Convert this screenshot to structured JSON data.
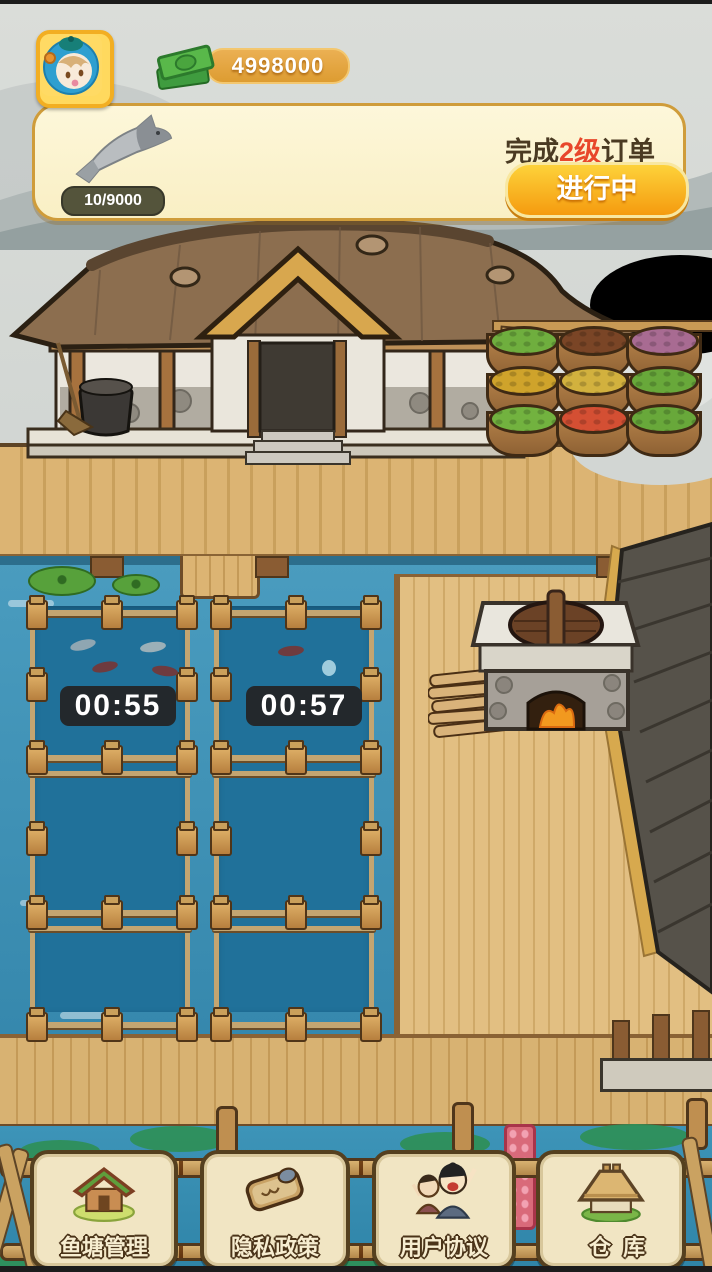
{
  "hud": {
    "coins": "4998000",
    "coin_icon": "banknote-icon",
    "avatar_icon": "player-avatar-icon"
  },
  "order_card": {
    "item_icon": "fish-ink-drawing",
    "progress": "10/9000",
    "title": {
      "prefix": "完成",
      "level": "2级",
      "suffix": "订单"
    },
    "status_button": "进行中"
  },
  "ponds": [
    {
      "timer": "00:55"
    },
    {
      "timer": "00:57"
    }
  ],
  "bottom_menu": [
    {
      "label": "鱼塘管理",
      "icon": "pond-house-icon"
    },
    {
      "label": "隐私政策",
      "icon": "scroll-icon"
    },
    {
      "label": "用户协议",
      "icon": "people-icon"
    },
    {
      "label": "仓库",
      "icon": "warehouse-icon"
    }
  ],
  "colors": {
    "accent_orange": "#F59B0F",
    "card_bg": "#FCF5D2",
    "water": "#3A8CB0",
    "pen_water": "#20719A",
    "timer_bg": "#23282C",
    "wood": "#D8B272",
    "button_bg": "#F1E5C3"
  }
}
